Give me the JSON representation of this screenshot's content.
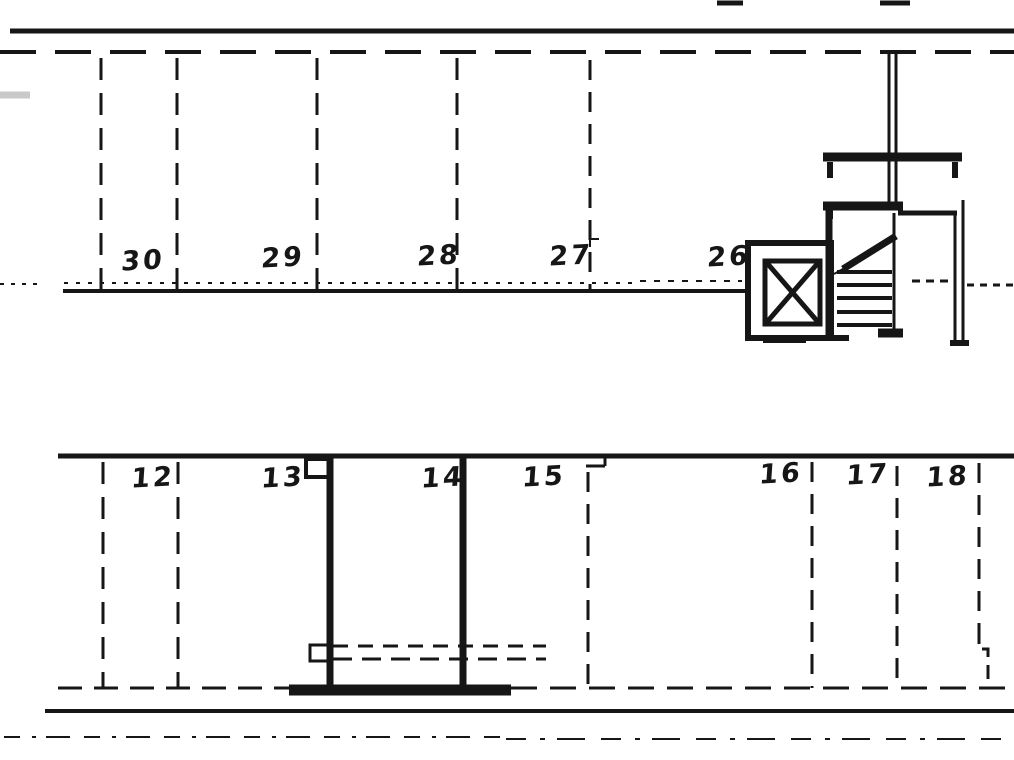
{
  "colors": {
    "background": "#ffffff",
    "ink": "#161616",
    "faint": "#c9c9c9"
  },
  "upper_row": {
    "stalls": [
      {
        "label": "30",
        "x": 143,
        "y": 261
      },
      {
        "label": "29",
        "x": 283,
        "y": 258
      },
      {
        "label": "28",
        "x": 439,
        "y": 256
      },
      {
        "label": "27",
        "x": 571,
        "y": 256
      },
      {
        "label": "26",
        "x": 729,
        "y": 257
      }
    ]
  },
  "lower_row": {
    "stalls": [
      {
        "label": "12",
        "x": 153,
        "y": 478
      },
      {
        "label": "13",
        "x": 283,
        "y": 478
      },
      {
        "label": "14",
        "x": 443,
        "y": 478
      },
      {
        "label": "15",
        "x": 544,
        "y": 477
      },
      {
        "label": "16",
        "x": 781,
        "y": 474
      },
      {
        "label": "17",
        "x": 868,
        "y": 475
      },
      {
        "label": "18",
        "x": 948,
        "y": 477
      }
    ]
  },
  "geometry": {
    "solids": [
      [
        717,
        3,
        743,
        3,
        5
      ],
      [
        880,
        3,
        910,
        3,
        5
      ],
      [
        10,
        31,
        1014,
        31,
        5
      ],
      [
        63,
        291,
        746,
        291,
        4
      ],
      [
        829,
        209,
        829,
        339,
        7
      ],
      [
        823,
        206,
        903,
        206,
        9
      ],
      [
        898,
        213,
        957,
        213,
        5
      ],
      [
        830,
        210,
        830,
        219,
        6
      ],
      [
        837,
        272,
        892,
        272,
        4
      ],
      [
        837,
        285,
        892,
        285,
        4
      ],
      [
        837,
        298,
        892,
        298,
        4
      ],
      [
        837,
        312,
        892,
        312,
        4
      ],
      [
        837,
        325,
        892,
        325,
        4
      ],
      [
        894,
        213,
        894,
        331,
        3
      ],
      [
        826,
        338,
        849,
        338,
        6
      ],
      [
        878,
        333,
        903,
        333,
        9
      ],
      [
        843,
        269,
        896,
        236,
        7
      ],
      [
        834,
        274,
        868,
        255,
        2
      ],
      [
        823,
        157,
        962,
        157,
        9
      ],
      [
        830,
        162,
        830,
        178,
        6
      ],
      [
        955,
        162,
        955,
        178,
        6
      ],
      [
        889,
        54,
        889,
        203,
        3
      ],
      [
        896,
        54,
        896,
        203,
        3
      ],
      [
        963,
        200,
        963,
        341,
        3
      ],
      [
        955,
        213,
        955,
        341,
        3
      ],
      [
        950,
        343,
        969,
        343,
        6
      ],
      [
        763,
        341,
        806,
        341,
        4
      ],
      [
        767,
        263,
        818,
        322,
        5
      ],
      [
        818,
        263,
        767,
        322,
        5
      ],
      [
        58,
        456,
        1014,
        456,
        5
      ],
      [
        330,
        457,
        330,
        691,
        7
      ],
      [
        463,
        457,
        463,
        691,
        7
      ],
      [
        289,
        690,
        511,
        690,
        11
      ],
      [
        45,
        711,
        1014,
        711,
        4
      ],
      [
        586,
        466,
        605,
        466,
        3
      ],
      [
        605,
        458,
        605,
        466,
        3
      ]
    ],
    "dashes": [
      [
        0,
        52,
        1014,
        52,
        4,
        "36 19"
      ],
      [
        101,
        58,
        101,
        289,
        3,
        "22 13"
      ],
      [
        177,
        58,
        177,
        289,
        3,
        "22 13"
      ],
      [
        317,
        58,
        317,
        289,
        3,
        "22 13"
      ],
      [
        457,
        58,
        457,
        289,
        3,
        "22 13"
      ],
      [
        590,
        60,
        590,
        289,
        3,
        "20 12"
      ],
      [
        0,
        284,
        42,
        284,
        2,
        "4 7"
      ],
      [
        64,
        283,
        636,
        283,
        2,
        "4 8"
      ],
      [
        640,
        281,
        742,
        281,
        2,
        "6 8"
      ],
      [
        912,
        281,
        948,
        281,
        3,
        "8 6"
      ],
      [
        967,
        285,
        1014,
        285,
        3,
        "7 6"
      ],
      [
        103,
        462,
        103,
        688,
        3,
        "22 13"
      ],
      [
        178,
        462,
        178,
        688,
        3,
        "22 13"
      ],
      [
        588,
        472,
        588,
        688,
        3,
        "20 12"
      ],
      [
        812,
        462,
        812,
        688,
        3,
        "20 12"
      ],
      [
        897,
        466,
        897,
        688,
        3,
        "20 12"
      ],
      [
        979,
        463,
        979,
        630,
        3,
        "20 12"
      ],
      [
        333,
        646,
        546,
        646,
        3,
        "15 10"
      ],
      [
        333,
        659,
        546,
        659,
        3,
        "19 10"
      ],
      [
        58,
        688,
        289,
        688,
        3,
        "24 12"
      ],
      [
        511,
        688,
        1014,
        688,
        3,
        "26 13"
      ],
      [
        4,
        737,
        502,
        737,
        2,
        "16 12 4 10 24 14"
      ],
      [
        506,
        739,
        1012,
        739,
        2,
        "20 14 5 12 28 16"
      ]
    ],
    "rects": [
      [
        748,
        243,
        83,
        95,
        6
      ],
      [
        765,
        261,
        55,
        63,
        5
      ],
      [
        306,
        459,
        24,
        18,
        4
      ],
      [
        310,
        645,
        18,
        16,
        3
      ]
    ],
    "polylines": [
      {
        "points": [
          [
            599,
            239
          ],
          [
            590,
            239
          ],
          [
            590,
            247
          ]
        ],
        "w": 2,
        "dash": ""
      },
      {
        "points": [
          [
            979,
            630
          ],
          [
            979,
            649
          ],
          [
            988,
            649
          ],
          [
            988,
            688
          ]
        ],
        "w": 3,
        "dash": "14 8"
      }
    ],
    "faint_solids": [
      [
        0,
        95,
        30,
        95,
        7
      ]
    ]
  }
}
